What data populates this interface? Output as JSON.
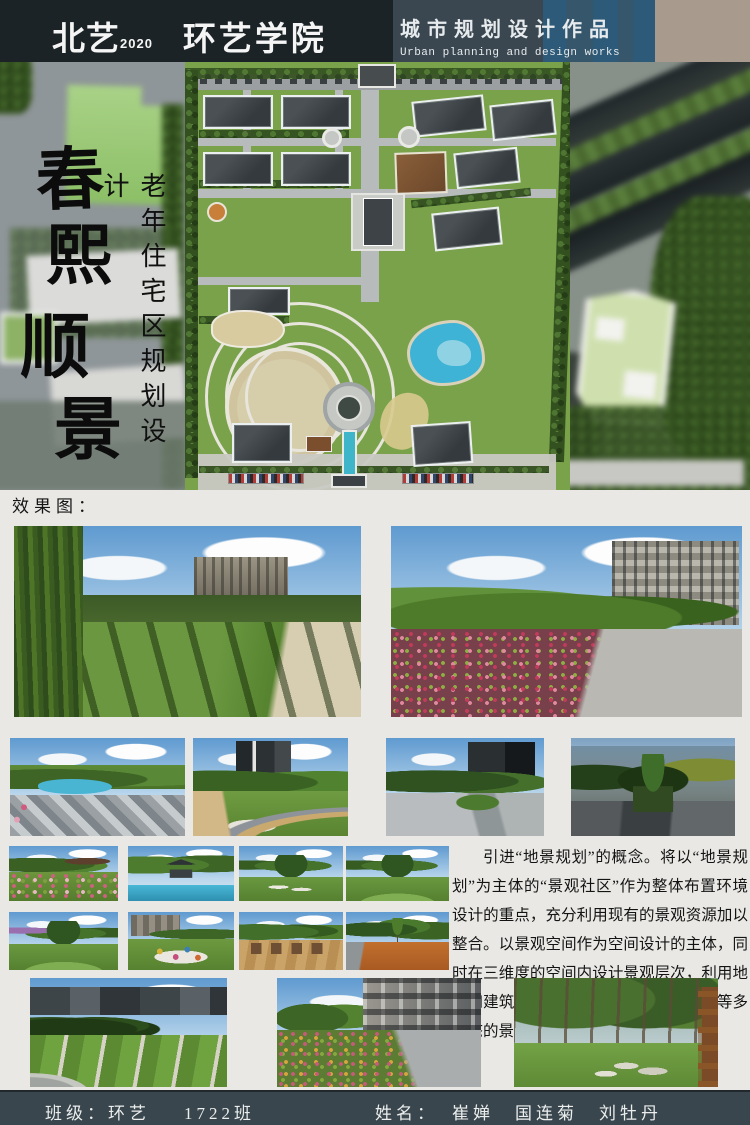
{
  "header": {
    "logo_primary": "北艺",
    "logo_year": "2020",
    "logo_secondary": "环艺学院",
    "title_cn": "城市规划设计作品",
    "title_en": "Urban planning and design works"
  },
  "hero": {
    "calligraphy": [
      "春",
      "熙",
      "顺",
      "景"
    ],
    "subtitle": "老年住宅区规划设计"
  },
  "gallery": {
    "label": "效果图："
  },
  "description": {
    "text": "引进“地景规划”的概念。将以“地景规划”为主体的“景观社区”作为整体布置环境设计的重点，充分利用现有的景观资源加以整合。以景观空间作为空间设计的主体，同时在三维度的空间内设计景观层次，利用地形和建筑手段营造出绿地、广场及水面等多形态的景观空间。"
  },
  "footer": {
    "class_label": "班级：环艺",
    "class_value": "1722班",
    "name_label": "姓名：",
    "names": "崔婵　国连菊　刘牡丹"
  },
  "colors": {
    "header_dark": "#1b2327",
    "header_slate": "#3a4751",
    "header_blue": "#2d5a78",
    "header_taupe": "#a89a8c",
    "footer_bar": "#39464d",
    "page_background": "#e9e8e5",
    "plan_lawn": "#79a24a",
    "plan_pond": "#3eb3d6"
  }
}
